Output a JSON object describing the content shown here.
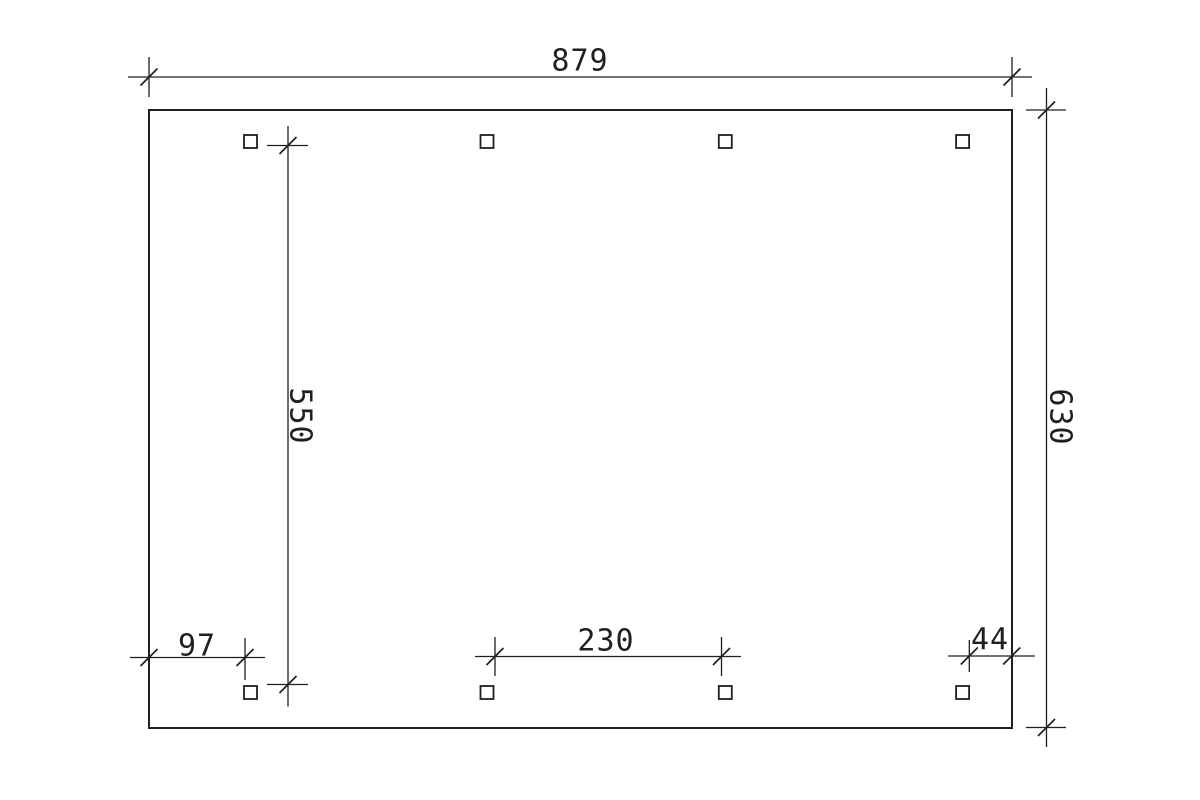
{
  "page": {
    "background": "#ffffff",
    "kind": "cad-dimension-floor-plan"
  },
  "drawing": {
    "line_color": "#1f1f1f",
    "canvas": {
      "width": 1200,
      "height": 800
    },
    "outline": {
      "x": 149,
      "y": 110,
      "width": 863,
      "height": 618,
      "stroke_width": 2
    },
    "posts": {
      "size": 13,
      "stroke_width": 1.8,
      "columns_x": [
        250.5,
        487,
        725.3,
        962.6
      ],
      "rows_y": [
        141.5,
        692.5
      ]
    },
    "tick": {
      "half_len": 8.5,
      "stroke_width": 1.7
    },
    "dim_stroke_width": 1.3,
    "dimensions": [
      {
        "label": "879",
        "orientation": "horizontal",
        "line_pos": 77,
        "line_start": 128,
        "line_end": 1032,
        "ticks": [
          149,
          1012
        ],
        "extensions": [
          {
            "pos": 149,
            "from": 57,
            "to": 97
          },
          {
            "pos": 1012,
            "from": 57,
            "to": 97
          }
        ],
        "label_x": 580,
        "label_y": 61,
        "label_rotation": 0
      },
      {
        "label": "550",
        "orientation": "vertical",
        "line_pos": 288,
        "line_start": 126,
        "line_end": 706.5,
        "ticks": [
          145.5,
          684.5
        ],
        "extensions": [
          {
            "pos": 145.5,
            "from": 267,
            "to": 308
          },
          {
            "pos": 684.5,
            "from": 267,
            "to": 308
          }
        ],
        "label_x": 300,
        "label_y": 416,
        "label_rotation": 90
      },
      {
        "label": "630",
        "orientation": "vertical",
        "line_pos": 1046.5,
        "line_start": 88,
        "line_end": 747,
        "ticks": [
          110,
          727.5
        ],
        "extensions": [
          {
            "pos": 110,
            "from": 1026,
            "to": 1066
          },
          {
            "pos": 727.5,
            "from": 1026,
            "to": 1066
          }
        ],
        "label_x": 1060,
        "label_y": 417,
        "label_rotation": 90
      },
      {
        "label": "97",
        "orientation": "horizontal",
        "line_pos": 657.5,
        "line_start": 130,
        "line_end": 265,
        "ticks": [
          149,
          245
        ],
        "extensions": [
          {
            "pos": 245,
            "from": 638,
            "to": 680
          }
        ],
        "label_x": 197,
        "label_y": 646,
        "label_rotation": 0
      },
      {
        "label": "230",
        "orientation": "horizontal",
        "line_pos": 656.5,
        "line_start": 475,
        "line_end": 741,
        "ticks": [
          495,
          721.5
        ],
        "extensions": [
          {
            "pos": 495,
            "from": 637,
            "to": 676
          },
          {
            "pos": 721.5,
            "from": 637,
            "to": 676
          }
        ],
        "label_x": 606,
        "label_y": 641,
        "label_rotation": 0
      },
      {
        "label": "44",
        "orientation": "horizontal",
        "line_pos": 656,
        "line_start": 948,
        "line_end": 1035,
        "ticks": [
          969.3,
          1011.7
        ],
        "extensions": [
          {
            "pos": 969.3,
            "from": 640,
            "to": 672
          }
        ],
        "label_x": 990,
        "label_y": 640,
        "label_rotation": 0
      }
    ]
  }
}
